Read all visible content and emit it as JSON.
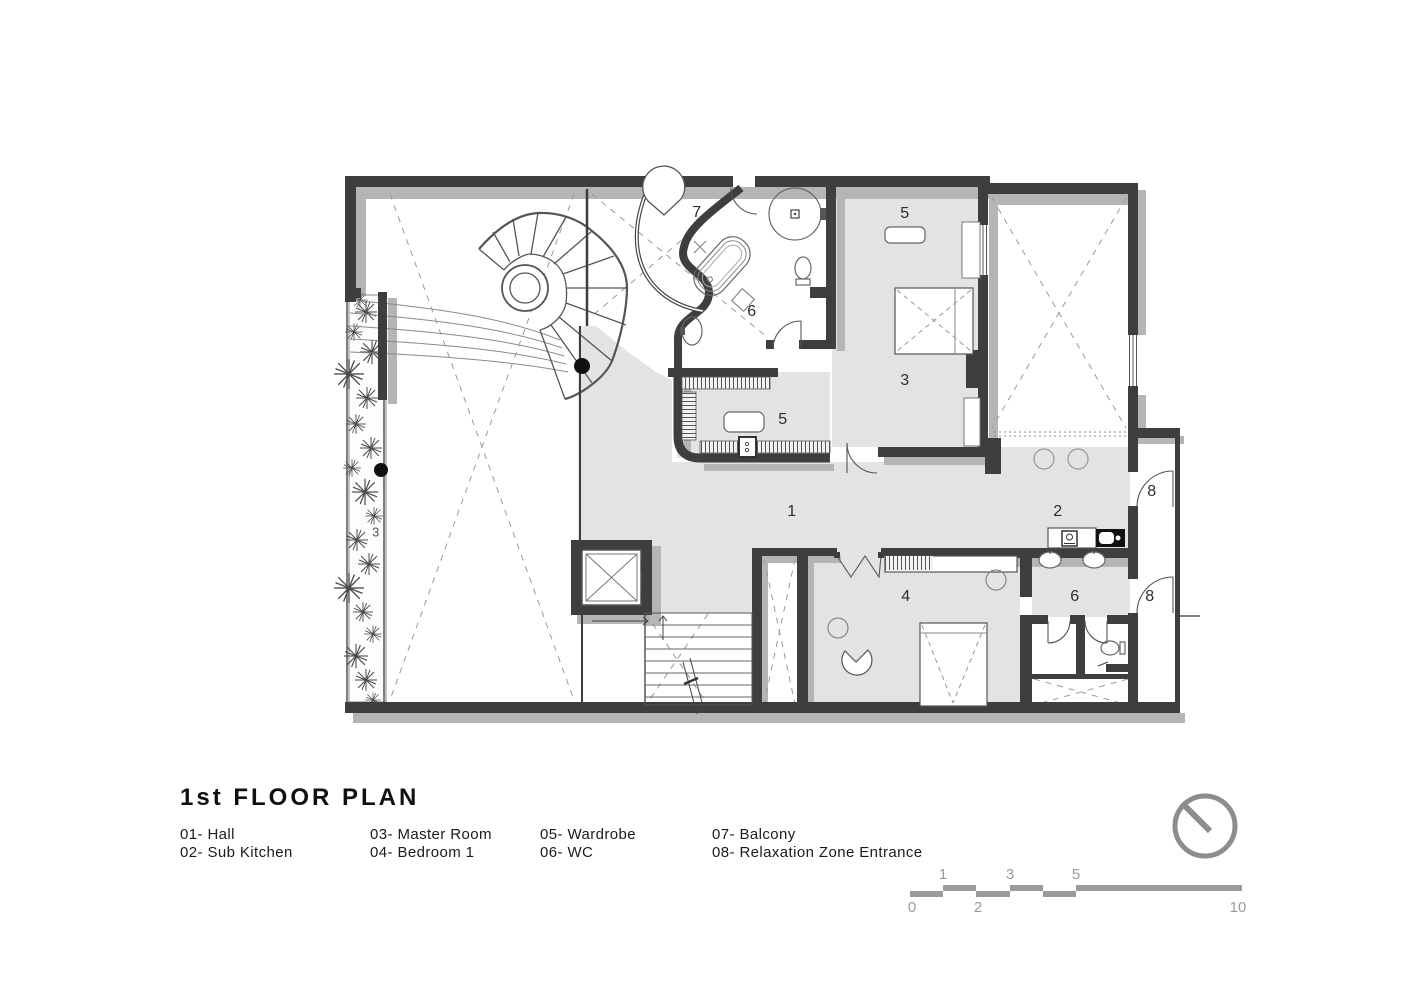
{
  "title": "1st FLOOR PLAN",
  "legend": {
    "col1": [
      "01- Hall",
      "02- Sub Kitchen"
    ],
    "col2": [
      "03- Master Room",
      "04- Bedroom 1"
    ],
    "col3": [
      "05- Wardrobe",
      "06- WC"
    ],
    "col4": [
      "07- Balcony",
      "08- Relaxation Zone Entrance"
    ]
  },
  "plan": {
    "labels": {
      "balcony": "7",
      "wardrobe_top": "5",
      "wc_top": "6",
      "master": "3",
      "wardrobe": "5",
      "hall": "1",
      "kitchen": "2",
      "entrance_a": "8",
      "bedroom": "4",
      "wc_bottom": "6",
      "entrance_b": "8",
      "planter": "3"
    }
  },
  "scale_bar": {
    "top": [
      "1",
      "3",
      "5"
    ],
    "bottom": [
      "0",
      "2",
      "10"
    ]
  },
  "colors": {
    "wall": "#3e3e3e",
    "shadow": "#b5b5b5",
    "floor": "#e3e3e3",
    "scale_gray": "#9b9b9b",
    "north_gray": "#8d8d8d"
  }
}
